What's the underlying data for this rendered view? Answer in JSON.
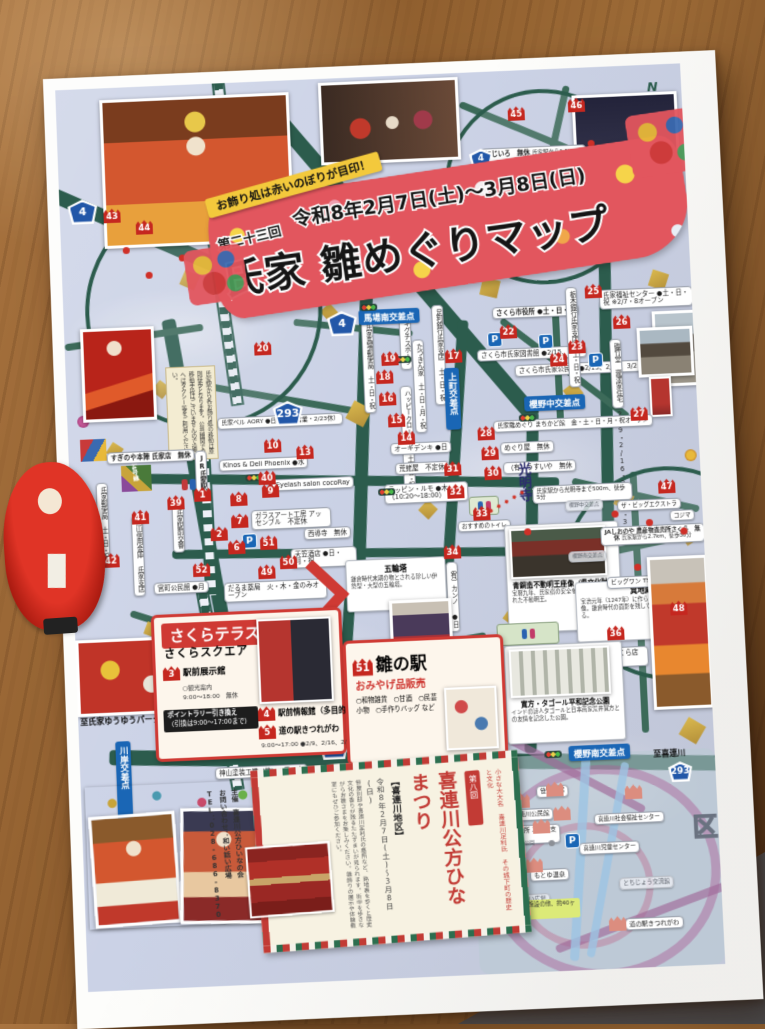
{
  "banner": {
    "ribbon": "お飾り処は赤いのぼりが目印！",
    "edition": "第二十三回",
    "dates": "令和8年2月7日(土)～3月8日(日)",
    "title": "氏家 雛めぐりマップ"
  },
  "compass": "N",
  "sh": {
    "r4": "4",
    "r293": "293"
  },
  "ix": {
    "babaminami": "馬場南交差点",
    "kamicho": "上町交差点",
    "nakacho": "櫻野中交差点",
    "minamicho": "櫻野南交差点",
    "ujiie": "氏家交差点",
    "kawagishi": "川岸交差点"
  },
  "roads": {
    "r4": "国道4号線",
    "r293": "国道293号線"
  },
  "station": "JR氏家駅",
  "notice": "氏家駅から各お飾り処の移動は原則徒歩となります。公共機関での移動手段はございませんので遠方へはタクシー等をご利用ください。",
  "m": {
    "1": "1",
    "2": "2",
    "6": "6",
    "7": "7",
    "8": "8",
    "9": "9",
    "10": "10",
    "13": "13",
    "14": "14",
    "15": "15",
    "16": "16",
    "17": "17",
    "18": "18",
    "19": "19",
    "20": "20",
    "21": "21",
    "22": "22",
    "23": "23",
    "24": "24",
    "25": "25",
    "26": "26",
    "27": "27",
    "28": "28",
    "29": "29",
    "30": "30",
    "31": "31",
    "32": "32",
    "33": "33",
    "34": "34",
    "35": "35",
    "36": "36",
    "37": "37",
    "38": "38",
    "39": "39",
    "40": "40",
    "41": "41",
    "42": "42",
    "43": "43",
    "44": "44",
    "45": "45",
    "46": "46",
    "47": "47",
    "48": "48",
    "49": "49",
    "50": "50",
    "51": "51",
    "52": "52",
    "3": "3",
    "4": "4",
    "5": "5"
  },
  "v": {
    "suginoya": "すぎのや本陣 氏家店　無休",
    "post": "氏家郵便局 土・日・祝",
    "babapost": "氏家馬場郵便局 土・日・祝",
    "akiguchi": "アキグチスポーツ",
    "tatsukin": "たつきん家 土・日・月・祝",
    "ashikaga": "足利銀行氏家支店 土・日・祝",
    "happy": "ハッピークローバー 土・日・祝",
    "cityhall": "さくら市役所 ●土・日・祝",
    "library": "さくら市氏家図書館 ●2/15、2/27",
    "kominkan": "さくら市氏家公民館 ●2/15、2/16、3/2",
    "tochigibank": "栃木銀行氏家支店 土・日・祝",
    "fukushi": "氏家福祉センター ●土・日・祝 ※2/7・8オープン",
    "isotake": "磯竹堂 瀧澤家住宅 2/9・2/16・2/23・3/2",
    "machikado": "氏家雛めぐり まちかど館　金・土・日・月・祝オープン",
    "meguriya": "めぐり屋　無休",
    "usuiya": "（有）うすいや　無休",
    "ogidenki": "オーギデンキ ●日",
    "rappin": "ラッピン・ルモ ●木（10:20～18:00）",
    "ebiya": "荒蛯屋　不定休",
    "phoenix": "Kinos & Deli Phoenix ●水",
    "cocoray": "Eyelash salon cocoRay",
    "assemble": "ガラスアート工房 アッセンブル　不定休",
    "saidoji": "西導寺　無休",
    "karasuyama": "烏山信用金庫 氏家支店",
    "koban": "氏家駅前交番",
    "aory": "氏家ベル AORY ●日（2/11営業・2/23休）",
    "amagasa": "天笠酒店 ●日・月・祝",
    "daruma": "だるま薬局　火・木・金のみオープン",
    "miyamachi": "宮町公民館 ●月",
    "kanno": "（有）カンノ ●日",
    "takaraya": "宝高屋　無休",
    "bigmeat": "ビッグミート山久さくら店 ●第3水曜",
    "kamiyama": "神山塗装工業（株）●日・水",
    "oonuki": "杉工房 オオヌキ　不定休",
    "yuyu": "至氏家ゆうゆうパーク",
    "toilet": "おすすめのトイレ"
  },
  "spots": {
    "imamiya": {
      "t": "氏家 今宮神社",
      "d": "11世紀の創建と伝えられる氏家の総鎮守。樹齢700年の公孫樹（イチョウの巨木）は県の天然記念物に指定されている。"
    },
    "gorinto": {
      "t": "五輪塔",
      "d": "鎌倉時代末期の物とされる珍しい伊勢型・大型の五輪塔。"
    },
    "fudo": {
      "t": "青銅造不動明王座像（県文化財）",
      "d": "宝暦九年、氏家宿の安全を記念して造立された不動明王。"
    },
    "jizo": {
      "t": "箕地蔵",
      "d": "宝治元年（1247年）に作られたとされる地蔵菩薩像。鎌倉時代の面影を残しているといわれている。"
    },
    "tagore": {
      "t": "寛方・タゴール平和記念公園",
      "d": "インドの詩人タゴールと日本画家荒井寛方との友情を記念した公園。"
    },
    "komyoji": {
      "t": "光明寺",
      "d": "氏家駅から光明寺まで500m、徒歩5分"
    }
  },
  "ins": {
    "gallery": {
      "t": "ギャラリー夢さわ 香月",
      "d": "氏家駅から1.7km、徒歩21分"
    },
    "nijiiro": {
      "t": "にじいろ　無休",
      "d": "氏家駅から1.5km、徒歩19分"
    },
    "ja": {
      "t": "JAしおのや 農産物直売所さくら　無休",
      "d": "氏家駅から2.7km、徒歩30分"
    },
    "bigone": "ビッグワン TSUTAYA",
    "bigextra": "ザ・ビッグエクストラ",
    "kojima": "コジマ"
  },
  "kt": {
    "to": "至喜連川",
    "district": "喜連川地区",
    "sasaya": "笹屋別邸",
    "kominkan": "喜連川公民館",
    "shisho": "さくら市役所 喜連川支所",
    "fukushi": "喜連川社会福祉センター",
    "jido": "喜連川児童センター",
    "motoyu": "もとゆ温泉",
    "waiwai": "和い話い広場",
    "tochijo": "とちじょう交流館",
    "michinoeki": "道の駅きつれがわ",
    "omaruyama": "お丸山公園",
    "note": "記載の公共施設の他、約40ヶ所にて展示"
  },
  "bx": {
    "terrace": {
      "title": "さくらテラス",
      "subtitle": "さくらスクエア",
      "i3": "駅前展示館",
      "i3n": "○観光案内",
      "i3h": "9:00～18:00　無休",
      "rally": "ポイントラリー引き換え",
      "rallyn": "（引換は9:00～17:00まで）",
      "i4": "駅前情報館（多目的室）",
      "i5": "道の駅きつれがわ",
      "hours": "9:00～17:00 ●2/9、2/16、2/24、3/2"
    },
    "hinaeki": {
      "title": "雛の駅",
      "subtitle": "おみやげ品販売",
      "items": "○和物雑貨　○甘酒　○民芸小物　○手作りバッグ など"
    },
    "festival": {
      "edition": "第八回",
      "title": "喜連川公方ひなまつり",
      "area": "【喜連川地区】",
      "dates": "令和8年2月7日(土)～3月8日(日)",
      "intro": "小さな大大名 喜連川足利氏 その城下町の歴史と文化",
      "desc": "笹屋別邸や喜連川足利氏の墓所など、路地裏を歩くと歴史文化の香りが残るたたずまいが見られます。街中を歩きながらお雛さまをお楽しみください。雛飾りの展示や体験教室にもぜひご参加ください。",
      "org": "主催　喜連川公方ひいなの会",
      "contact": "お問い合わせ：和い話い広場",
      "tel": "TEL：028-686-8370"
    }
  }
}
